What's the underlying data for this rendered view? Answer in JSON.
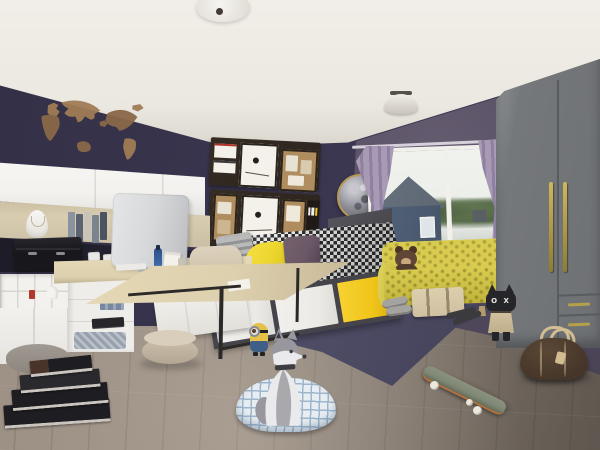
{
  "image_type": "3d-interior-render",
  "room": "teen bedroom with navy walls, yellow accents and pet husky",
  "texts": {
    "pillow_print": "NEW YORK",
    "cat_face_eyes": "O X"
  },
  "objects": [
    "world-map wall decal",
    "ceiling dome lamps",
    "white wall cabinets",
    "open shelf with necklace bust, books and cactus",
    "black storage chest",
    "desk with black metal frame",
    "all-in-one computer monitor",
    "beige armchair",
    "beige pouf",
    "white cubby organizer",
    "daybed with white and yellow drawers",
    "houndstooth duvet",
    "yellow pillow",
    "purple cushion",
    "New York print pillow",
    "pin-board collage frames",
    "moon wall mirror",
    "window with house view",
    "lilac curtains",
    "yellow quilted sofa",
    "teddy bear",
    "suitcase under sofa",
    "slippers",
    "sandals",
    "grey wardrobe with gold handles",
    "cat plush with O X face",
    "brown duffel bag",
    "skateboard",
    "husky dog",
    "plaid dog bed",
    "minion figure",
    "dark blue rug",
    "stacked books on floor",
    "wood plank floor"
  ],
  "palette": {
    "ceiling": "#ebe8e1",
    "ceiling_edge": "#d9d5cc",
    "wall_back": "#3a3650",
    "wall_right": "#5d5468",
    "wall_right_dark": "#4a4356",
    "floor_light": "#a3968a",
    "floor_mid": "#8d8177",
    "floor_dark": "#5f574f",
    "rug_light": "#55536d",
    "rug_dark": "#434158",
    "map_brown": "#8a6847",
    "map_brown_2": "#a07c55",
    "cabinet_white": "#f2f1ee",
    "cabinet_seam": "#d9d6d1",
    "shelf_wood": "#d8ccb1",
    "shelf_wood_dark": "#c5b99e",
    "counter_dark": "#23222e",
    "chest_black": "#17171c",
    "desk_wood": "#ddd0ae",
    "desk_wood_dark": "#b5a785",
    "metal_black": "#2c2a28",
    "monitor_gray": "#d6d8da",
    "monitor_gray_dark": "#bcbec1",
    "drawer_frame": "#45444b",
    "drawer_white": "#eceae6",
    "accent_yellow": "#f0c519",
    "duvet_dark": "#2e2e31",
    "duvet_light": "#e8e8e5",
    "pillow_yellow": "#edd62f",
    "cushion_purple": "#6b5866",
    "pillow_white": "#f2f1ed",
    "sofa_yellow": "#d8cb4f",
    "sofa_yellow_dark": "#c0b33a",
    "curtain_lilac": "#a89ab4",
    "curtain_fold": "#8e80a0",
    "rod_gray": "#d6d0da",
    "wardrobe_gray": "#75787b",
    "wardrobe_side": "#86898c",
    "wardrobe_seam": "#595c5f",
    "handle_gold": "#b5a049",
    "window_frame": "#f1f0ea",
    "sky": "#eceeea",
    "tree_green": "#667c55",
    "tree_green_dark": "#4f6343",
    "house_wall": "#475669",
    "house_roof": "#5d6773",
    "teddy_brown": "#5f4636",
    "teddy_light": "#c9a87c",
    "suitcase_tan": "#cfc0a0",
    "duffel_brown": "#463629",
    "duffel_tan": "#d2bd92",
    "plaid_base": "#e7edf1",
    "plaid_line": "#9db6cd",
    "dog_white": "#eaeaec",
    "dog_gray": "#97979d",
    "dog_dark": "#3c3c42",
    "minion_yellow": "#e6c14a",
    "minion_blue": "#3f5f88",
    "skate_deck": "#7f8875",
    "skate_orange": "#b4703c",
    "wheel_white": "#ece8de",
    "pouf_beige": "#cdc1ae",
    "chair_beige": "#d5c9b3",
    "cork": "#b08d5f",
    "panel_dark": "#2b241e",
    "paper_white": "#f3f1ea",
    "book_dark": "#1e1e22",
    "page_light": "#cac6bf",
    "moon_rim": "#b59a55",
    "moon_light": "#c6c6cc",
    "moon_mid": "#92929a",
    "moon_dark": "#5e5e68",
    "cat_black": "#26262a",
    "cat_cape": "#d2c2a0"
  }
}
